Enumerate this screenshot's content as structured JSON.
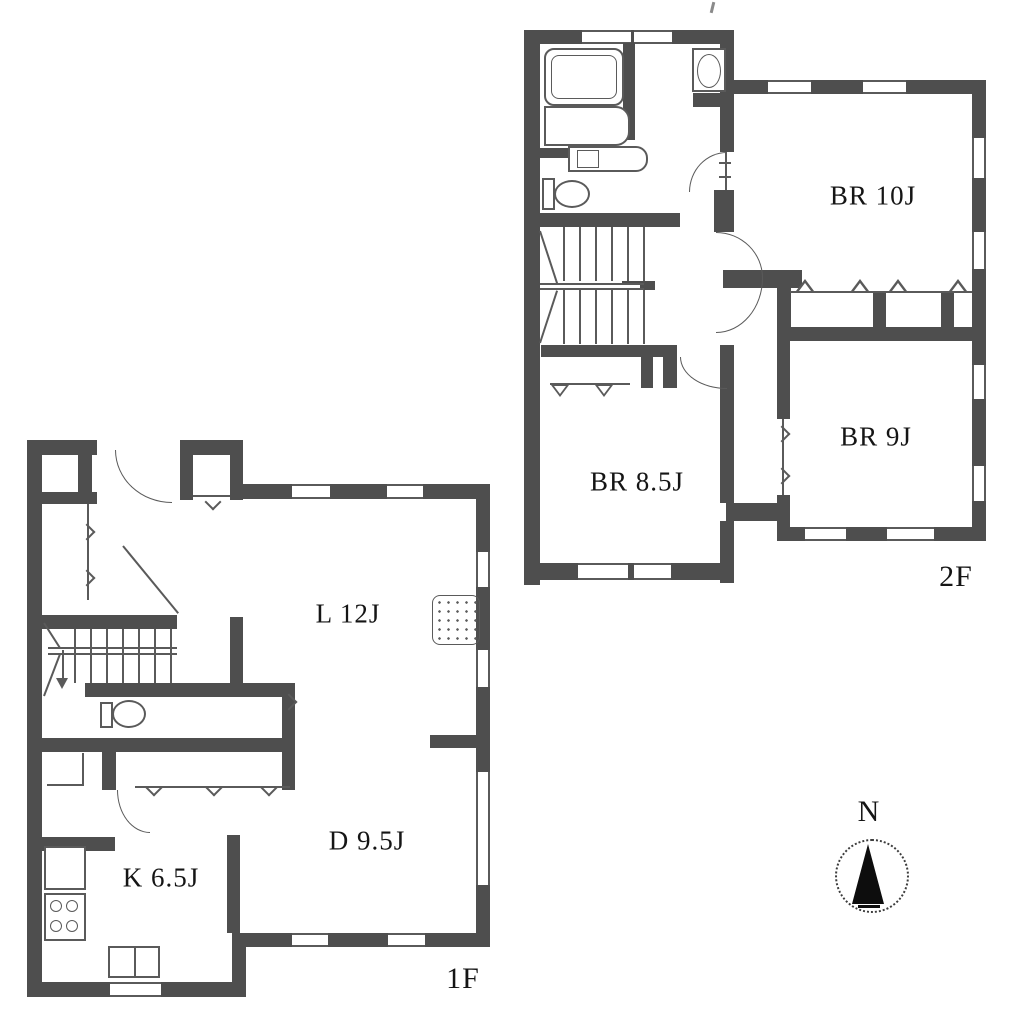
{
  "title": "Two-storey house floor plan",
  "floor2": {
    "label": "2F",
    "rooms": {
      "br10": {
        "label": "BR 10J"
      },
      "br9": {
        "label": "BR 9J"
      },
      "br85": {
        "label": "BR 8.5J"
      }
    }
  },
  "floor1": {
    "label": "1F",
    "rooms": {
      "living": {
        "label": "L 12J"
      },
      "dining": {
        "label": "D 9.5J"
      },
      "kitchen": {
        "label": "K 6.5J"
      }
    }
  },
  "compass": {
    "north_label": "N"
  },
  "colors": {
    "wall": "#4e4e4e",
    "line": "#5a5a5a",
    "text": "#151515",
    "background": "#ffffff"
  }
}
